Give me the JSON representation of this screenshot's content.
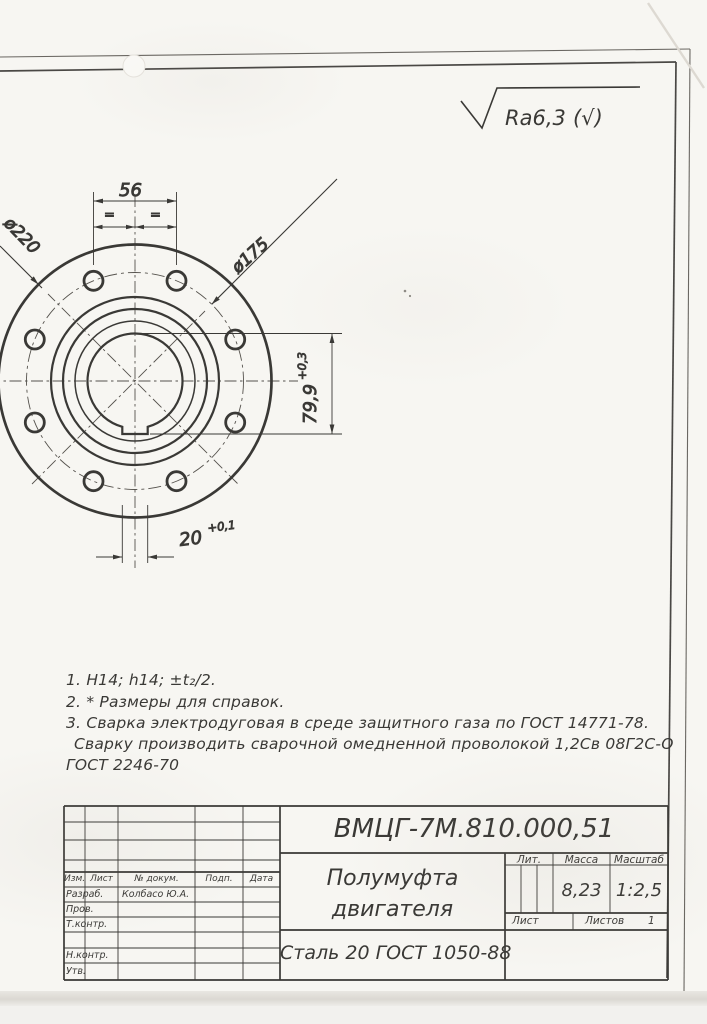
{
  "colors": {
    "ink": "#3a3936",
    "paper": "#f7f6f2"
  },
  "surface_finish": {
    "value": "Ra6,3",
    "reference": "(√)"
  },
  "drawing": {
    "dims": {
      "hole_pair_spacing": "56",
      "eq_left": "=",
      "eq_right": "=",
      "outer_diameter": "ø220",
      "bolt_circle_diameter": "ø175",
      "bore_keyway_depth": "79,9",
      "bore_keyway_depth_tolerance": "+0,3",
      "keyway_width": "20",
      "keyway_width_tolerance": "+0,1"
    }
  },
  "notes": [
    "1. H14; h14; ±t₂/2.",
    "2. * Размеры для справок.",
    "3. Сварка электродуговая в среде защитного газа по ГОСТ 14771-78.",
    "Сварку производить сварочной омедненной проволокой 1,2Св 08Г2С-О",
    "ГОСТ 2246-70"
  ],
  "title_block": {
    "designation": "ВМЦГ-7М.810.000,51",
    "part_name_line1": "Полумуфта",
    "part_name_line2": "двигателя",
    "material": "Сталь 20 ГОСТ 1050-88",
    "labels": {
      "lit": "Лит.",
      "mass": "Масса",
      "scale": "Масштаб",
      "sheet": "Лист",
      "sheets": "Листов",
      "izm": "Изм.",
      "list": "Лист",
      "doc_no": "№ докум.",
      "sign": "Подп.",
      "date": "Дата",
      "developed": "Разраб.",
      "checked": "Пров.",
      "t_control": "Т.контр.",
      "n_control": "Н.контр.",
      "approved": "Утв."
    },
    "values": {
      "mass": "8,23",
      "scale": "1:2,5",
      "sheets_count": "1",
      "developer_name": "Колбасо Ю.А."
    }
  }
}
